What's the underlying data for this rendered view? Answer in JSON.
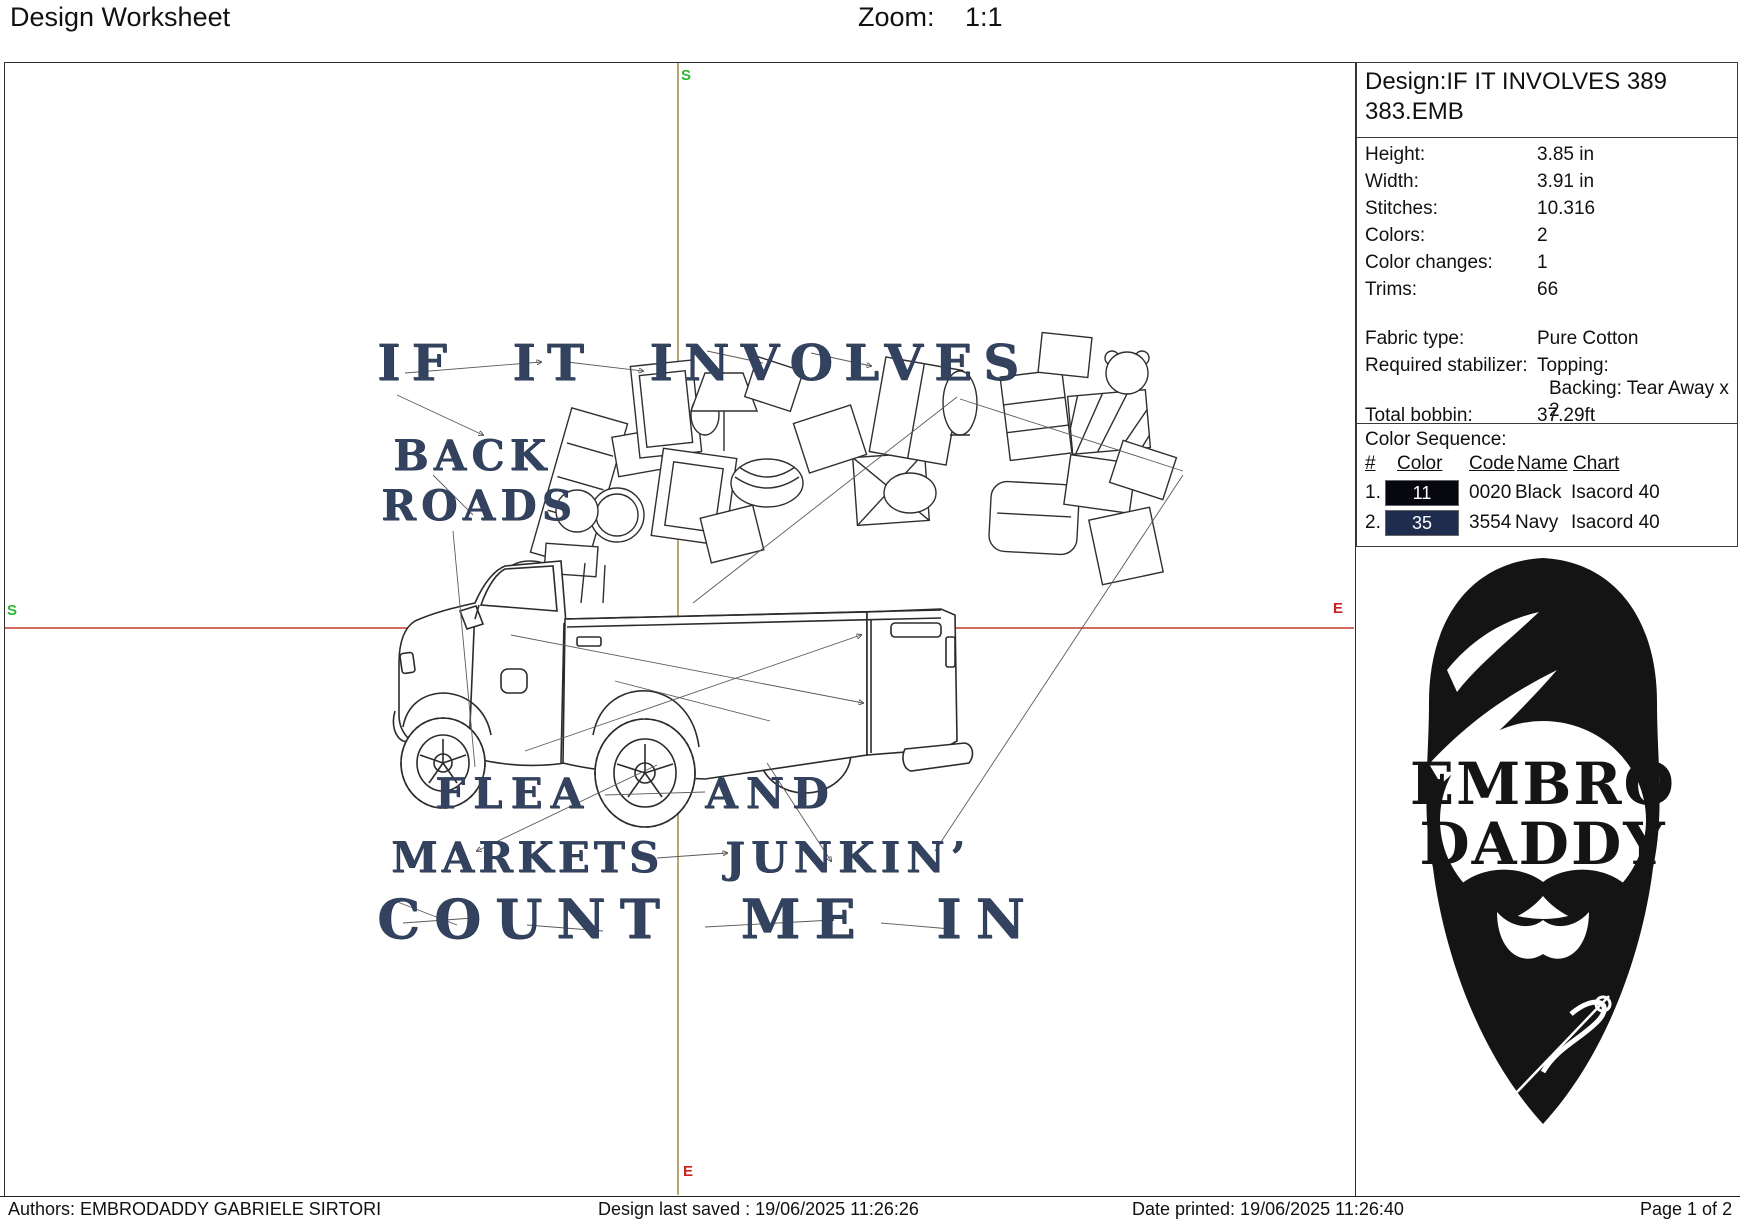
{
  "header": {
    "title": "Design Worksheet",
    "zoom_label": "Zoom:",
    "zoom_value": "1:1"
  },
  "panel": {
    "design_name": "Design:IF IT INVOLVES 389 383.EMB",
    "stats": [
      {
        "label": "Height:",
        "value": "3.85 in"
      },
      {
        "label": "Width:",
        "value": "3.91 in"
      },
      {
        "label": "Stitches:",
        "value": "10.316"
      },
      {
        "label": "Colors:",
        "value": "2"
      },
      {
        "label": "Color changes:",
        "value": "1"
      },
      {
        "label": "Trims:",
        "value": "66"
      }
    ],
    "fabric": {
      "fabric_label": "Fabric type:",
      "fabric_value": "Pure Cotton",
      "stabilizer_label": "Required stabilizer:",
      "stabilizer_value": "Topping:",
      "stabilizer_value2": "Backing: Tear Away x 2",
      "bobbin_label": "Total bobbin:",
      "bobbin_value": "37.29ft"
    },
    "color_sequence": {
      "title": "Color Sequence:",
      "columns": {
        "num": "#",
        "color": "Color",
        "code": "Code",
        "name": "Name",
        "chart": "Chart"
      },
      "rows": [
        {
          "num": "1.",
          "swatch": "11",
          "swatch_color": "#07070f",
          "code": "0020",
          "name": "Black",
          "chart": "Isacord 40"
        },
        {
          "num": "2.",
          "swatch": "35",
          "swatch_color": "#1f2c4e",
          "code": "3554",
          "name": "Navy",
          "chart": "Isacord 40"
        }
      ]
    }
  },
  "design": {
    "thread_color": "#33425e",
    "crosshair_vertical_color": "#9d7c3a",
    "crosshair_horizontal_color": "#c33b27",
    "marker_start_color": "#2fb52f",
    "marker_end_color": "#cc1f1f",
    "markers": {
      "start": "S",
      "end": "E"
    },
    "lines": {
      "line1": "IF IT INVOLVES",
      "back": "BACK",
      "roads": "ROADS",
      "flea": "FLEA",
      "and": "AND",
      "markets": "MARKETS",
      "junkin": "JUNKIN’",
      "line5": "COUNT ME IN"
    }
  },
  "logo": {
    "line1": "EMBRO",
    "line2": "DADDY"
  },
  "footer": {
    "authors": "Authors: EMBRODADDY GABRIELE SIRTORI",
    "last_saved": "Design last saved : 19/06/2025 11:26:26",
    "printed": "Date printed: 19/06/2025 11:26:40",
    "page": "Page 1 of 2"
  }
}
